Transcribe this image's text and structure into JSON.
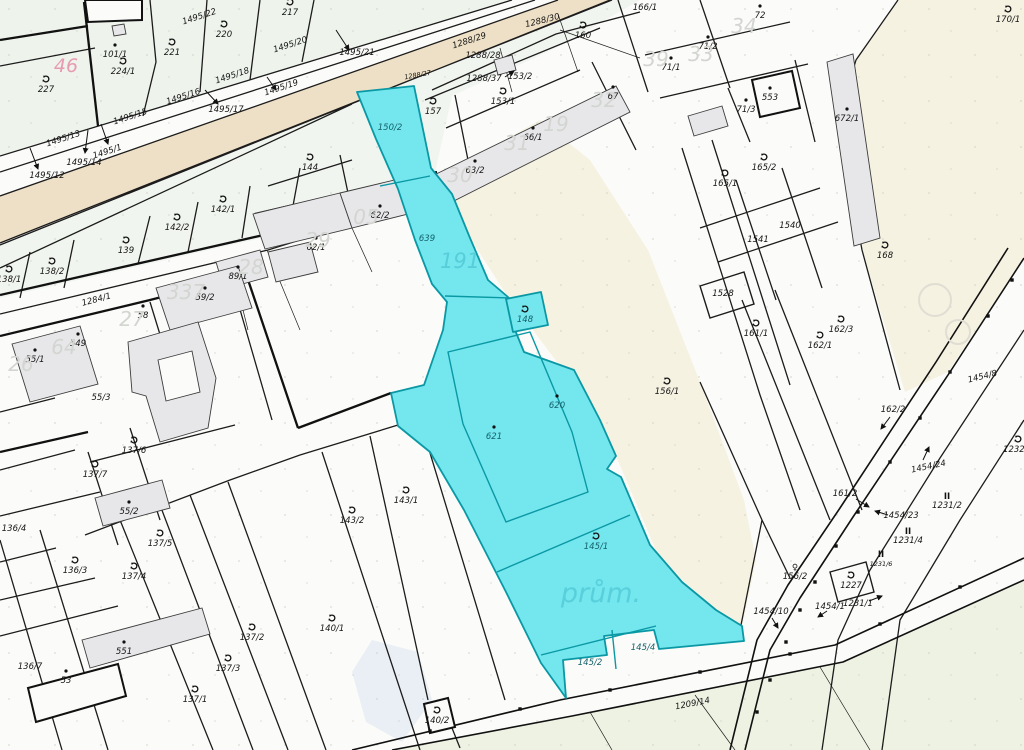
{
  "map": {
    "type": "cadastral-parcel-map",
    "zone_label": "prům.",
    "colors": {
      "highlight_fill": "#73e6ee",
      "highlight_stroke": "#0a98a4",
      "road_fill": "#eee0c6",
      "cream": "#f6f2e2",
      "green_tint": "#eef3ec",
      "bottom_green": "#edf2e3",
      "big_number_gray": "#d2d5d0",
      "pink": "#e79bb1",
      "teal_text": "#15616b",
      "teal_big": "#54cbd8"
    },
    "highlighted_parcels": [
      "150/2",
      "639",
      "148",
      "620",
      "621",
      "145/1",
      "145/2",
      "145/4"
    ]
  },
  "labels": [
    {
      "text": "101/1",
      "x": 115,
      "y": 57,
      "cls": "p",
      "marker": "dot"
    },
    {
      "text": "227",
      "x": 46,
      "y": 92,
      "cls": "p",
      "marker": "sym"
    },
    {
      "text": "224/1",
      "x": 123,
      "y": 74,
      "cls": "p",
      "marker": "sym"
    },
    {
      "text": "221",
      "x": 172,
      "y": 55,
      "cls": "p",
      "marker": "sym"
    },
    {
      "text": "220",
      "x": 224,
      "y": 37,
      "cls": "p",
      "marker": "sym"
    },
    {
      "text": "217",
      "x": 290,
      "y": 15,
      "cls": "p",
      "marker": "sym"
    },
    {
      "text": "144",
      "x": 310,
      "y": 170,
      "cls": "p",
      "marker": "sym"
    },
    {
      "text": "157",
      "x": 433,
      "y": 114,
      "cls": "p",
      "marker": "sym"
    },
    {
      "text": "142/1",
      "x": 223,
      "y": 212,
      "cls": "p",
      "marker": "sym"
    },
    {
      "text": "142/2",
      "x": 177,
      "y": 230,
      "cls": "p",
      "marker": "sym"
    },
    {
      "text": "139",
      "x": 126,
      "y": 253,
      "cls": "p",
      "marker": "sym"
    },
    {
      "text": "138/2",
      "x": 52,
      "y": 274,
      "cls": "p",
      "marker": "sym"
    },
    {
      "text": "138/1",
      "x": 9,
      "y": 282,
      "cls": "p",
      "marker": "sym"
    },
    {
      "text": "59/2",
      "x": 205,
      "y": 300,
      "cls": "p",
      "marker": "dot"
    },
    {
      "text": "89/1",
      "x": 238,
      "y": 279,
      "cls": "p",
      "marker": "dot"
    },
    {
      "text": "62/2",
      "x": 380,
      "y": 218,
      "cls": "p",
      "marker": "dot"
    },
    {
      "text": "62/1",
      "x": 316,
      "y": 250,
      "cls": "p",
      "marker": "dot"
    },
    {
      "text": "58",
      "x": 143,
      "y": 318,
      "cls": "p",
      "marker": "dot"
    },
    {
      "text": "549",
      "x": 78,
      "y": 346,
      "cls": "p",
      "marker": "dot"
    },
    {
      "text": "55/1",
      "x": 35,
      "y": 362,
      "cls": "p",
      "marker": "dot"
    },
    {
      "text": "55/3",
      "x": 101,
      "y": 400,
      "cls": "p"
    },
    {
      "text": "137/6",
      "x": 134,
      "y": 453,
      "cls": "p",
      "marker": "sym"
    },
    {
      "text": "137/7",
      "x": 95,
      "y": 477,
      "cls": "p",
      "marker": "sym"
    },
    {
      "text": "55/2",
      "x": 129,
      "y": 514,
      "cls": "p",
      "marker": "dot"
    },
    {
      "text": "136/4",
      "x": 14,
      "y": 531,
      "cls": "p"
    },
    {
      "text": "136/3",
      "x": 75,
      "y": 573,
      "cls": "p",
      "marker": "sym"
    },
    {
      "text": "137/5",
      "x": 160,
      "y": 546,
      "cls": "p",
      "marker": "sym"
    },
    {
      "text": "137/4",
      "x": 134,
      "y": 579,
      "cls": "p",
      "marker": "sym"
    },
    {
      "text": "551",
      "x": 124,
      "y": 654,
      "cls": "p",
      "marker": "dot"
    },
    {
      "text": "136/7",
      "x": 30,
      "y": 669,
      "cls": "p"
    },
    {
      "text": "53",
      "x": 66,
      "y": 683,
      "cls": "p",
      "marker": "dot"
    },
    {
      "text": "137/2",
      "x": 252,
      "y": 640,
      "cls": "p",
      "marker": "sym"
    },
    {
      "text": "137/3",
      "x": 228,
      "y": 671,
      "cls": "p",
      "marker": "sym"
    },
    {
      "text": "137/1",
      "x": 195,
      "y": 702,
      "cls": "p",
      "marker": "sym"
    },
    {
      "text": "140/1",
      "x": 332,
      "y": 631,
      "cls": "p",
      "marker": "sym"
    },
    {
      "text": "140/2",
      "x": 437,
      "y": 723,
      "cls": "p",
      "marker": "sym"
    },
    {
      "text": "143/1",
      "x": 406,
      "y": 503,
      "cls": "p",
      "marker": "sym"
    },
    {
      "text": "143/2",
      "x": 352,
      "y": 523,
      "cls": "p",
      "marker": "sym"
    },
    {
      "text": "1284/1",
      "x": 97,
      "y": 302,
      "cls": "road",
      "rot": -15
    },
    {
      "text": "1495/22",
      "x": 200,
      "y": 19,
      "cls": "road",
      "rot": -18
    },
    {
      "text": "1495/20",
      "x": 291,
      "y": 47,
      "cls": "road",
      "rot": -18
    },
    {
      "text": "1495/21",
      "x": 357,
      "y": 55,
      "cls": "road"
    },
    {
      "text": "1495/19",
      "x": 282,
      "y": 90,
      "cls": "road",
      "rot": -18
    },
    {
      "text": "1495/18",
      "x": 233,
      "y": 78,
      "cls": "road",
      "rot": -18
    },
    {
      "text": "1495/17",
      "x": 226,
      "y": 112,
      "cls": "road"
    },
    {
      "text": "1495/16",
      "x": 184,
      "y": 99,
      "cls": "road",
      "rot": -18
    },
    {
      "text": "1495/15",
      "x": 131,
      "y": 119,
      "cls": "road",
      "rot": -18
    },
    {
      "text": "1495/13",
      "x": 64,
      "y": 141,
      "cls": "road",
      "rot": -18
    },
    {
      "text": "1495/1",
      "x": 108,
      "y": 154,
      "cls": "road",
      "rot": -18
    },
    {
      "text": "1495/14",
      "x": 84,
      "y": 165,
      "cls": "road"
    },
    {
      "text": "1495/12",
      "x": 47,
      "y": 178,
      "cls": "road"
    },
    {
      "text": "1288/27",
      "x": 418,
      "y": 77,
      "cls": "tiny",
      "rot": -10
    },
    {
      "text": "1288/29",
      "x": 470,
      "y": 43,
      "cls": "road",
      "rot": -18
    },
    {
      "text": "1288/28",
      "x": 483,
      "y": 58,
      "cls": "road"
    },
    {
      "text": "1288/30",
      "x": 543,
      "y": 23,
      "cls": "road",
      "rot": -14
    },
    {
      "text": "1288/37",
      "x": 484,
      "y": 81,
      "cls": "road"
    },
    {
      "text": "153/2",
      "x": 520,
      "y": 79,
      "cls": "p"
    },
    {
      "text": "153/1",
      "x": 503,
      "y": 104,
      "cls": "p",
      "marker": "sym"
    },
    {
      "text": "160",
      "x": 583,
      "y": 38,
      "cls": "p",
      "marker": "sym"
    },
    {
      "text": "166/1",
      "x": 645,
      "y": 10,
      "cls": "p",
      "marker": "dot"
    },
    {
      "text": "72",
      "x": 760,
      "y": 18,
      "cls": "p",
      "marker": "dot"
    },
    {
      "text": "71/2",
      "x": 708,
      "y": 49,
      "cls": "p",
      "marker": "dot"
    },
    {
      "text": "71/1",
      "x": 671,
      "y": 70,
      "cls": "p",
      "marker": "dot"
    },
    {
      "text": "71/3",
      "x": 746,
      "y": 112,
      "cls": "p",
      "marker": "dot"
    },
    {
      "text": "553",
      "x": 770,
      "y": 100,
      "cls": "p",
      "marker": "dot"
    },
    {
      "text": "67",
      "x": 613,
      "y": 99,
      "cls": "p",
      "marker": "dot"
    },
    {
      "text": "66/1",
      "x": 533,
      "y": 140,
      "cls": "p",
      "marker": "dot"
    },
    {
      "text": "63/2",
      "x": 475,
      "y": 173,
      "cls": "p",
      "marker": "dot"
    },
    {
      "text": "672/1",
      "x": 847,
      "y": 121,
      "cls": "p",
      "marker": "dot"
    },
    {
      "text": "170/1",
      "x": 1008,
      "y": 22,
      "cls": "p",
      "marker": "sym"
    },
    {
      "text": "165/1",
      "x": 725,
      "y": 186,
      "cls": "p",
      "marker": "sym"
    },
    {
      "text": "165/2",
      "x": 764,
      "y": 170,
      "cls": "p",
      "marker": "sym"
    },
    {
      "text": "1540",
      "x": 790,
      "y": 228,
      "cls": "p"
    },
    {
      "text": "1541",
      "x": 758,
      "y": 242,
      "cls": "p"
    },
    {
      "text": "1528",
      "x": 723,
      "y": 296,
      "cls": "p"
    },
    {
      "text": "161/1",
      "x": 756,
      "y": 336,
      "cls": "p",
      "marker": "sym"
    },
    {
      "text": "162/1",
      "x": 820,
      "y": 348,
      "cls": "p",
      "marker": "sym"
    },
    {
      "text": "162/3",
      "x": 841,
      "y": 332,
      "cls": "p",
      "marker": "sym"
    },
    {
      "text": "168",
      "x": 885,
      "y": 258,
      "cls": "p",
      "marker": "sym"
    },
    {
      "text": "156/1",
      "x": 667,
      "y": 394,
      "cls": "p",
      "marker": "sym"
    },
    {
      "text": "1454/8",
      "x": 983,
      "y": 379,
      "cls": "road",
      "rot": -14
    },
    {
      "text": "162/2",
      "x": 893,
      "y": 412,
      "cls": "p"
    },
    {
      "text": "1454/24",
      "x": 929,
      "y": 469,
      "cls": "road",
      "rot": -12
    },
    {
      "text": "1232/1",
      "x": 1018,
      "y": 452,
      "cls": "p",
      "marker": "sym"
    },
    {
      "text": "1231/2",
      "x": 947,
      "y": 508,
      "cls": "p",
      "marker": "II"
    },
    {
      "text": "1231/4",
      "x": 908,
      "y": 543,
      "cls": "p",
      "marker": "II"
    },
    {
      "text": "1231/6",
      "x": 881,
      "y": 566,
      "cls": "tiny",
      "marker": "II"
    },
    {
      "text": "161/2",
      "x": 845,
      "y": 496,
      "cls": "p"
    },
    {
      "text": "1454/23",
      "x": 901,
      "y": 518,
      "cls": "road"
    },
    {
      "text": "1227",
      "x": 851,
      "y": 588,
      "cls": "p",
      "marker": "sym"
    },
    {
      "text": "1231/1",
      "x": 858,
      "y": 606,
      "cls": "p"
    },
    {
      "text": "1454/1",
      "x": 830,
      "y": 609,
      "cls": "road"
    },
    {
      "text": "156/2",
      "x": 795,
      "y": 579,
      "cls": "p",
      "marker": "fem"
    },
    {
      "text": "1454/10",
      "x": 771,
      "y": 614,
      "cls": "road"
    },
    {
      "text": "1209/14",
      "x": 693,
      "y": 706,
      "cls": "road",
      "rot": -11
    },
    {
      "text": "150/2",
      "x": 390,
      "y": 130,
      "cls": "t"
    },
    {
      "text": "639",
      "x": 427,
      "y": 241,
      "cls": "t"
    },
    {
      "text": "148",
      "x": 525,
      "y": 322,
      "cls": "t",
      "marker": "sym"
    },
    {
      "text": "620",
      "x": 557,
      "y": 408,
      "cls": "t",
      "marker": "dot"
    },
    {
      "text": "621",
      "x": 494,
      "y": 439,
      "cls": "t",
      "marker": "dot"
    },
    {
      "text": "145/1",
      "x": 596,
      "y": 549,
      "cls": "t",
      "marker": "sym"
    },
    {
      "text": "145/2",
      "x": 590,
      "y": 665,
      "cls": "t"
    },
    {
      "text": "145/4",
      "x": 643,
      "y": 650,
      "cls": "t"
    },
    {
      "text": "46",
      "x": 66,
      "y": 72,
      "cls": "pink"
    },
    {
      "text": "34",
      "x": 744,
      "y": 33,
      "cls": "big"
    },
    {
      "text": "33",
      "x": 701,
      "y": 61,
      "cls": "big"
    },
    {
      "text": "39",
      "x": 656,
      "y": 66,
      "cls": "big"
    },
    {
      "text": "32",
      "x": 604,
      "y": 107,
      "cls": "big"
    },
    {
      "text": "19",
      "x": 556,
      "y": 131,
      "cls": "big"
    },
    {
      "text": "31",
      "x": 517,
      "y": 150,
      "cls": "big"
    },
    {
      "text": "30",
      "x": 460,
      "y": 182,
      "cls": "big"
    },
    {
      "text": "29",
      "x": 318,
      "y": 247,
      "cls": "big"
    },
    {
      "text": "05",
      "x": 366,
      "y": 224,
      "cls": "big"
    },
    {
      "text": "28",
      "x": 251,
      "y": 274,
      "cls": "big"
    },
    {
      "text": "337",
      "x": 186,
      "y": 299,
      "cls": "big"
    },
    {
      "text": "27",
      "x": 132,
      "y": 326,
      "cls": "big"
    },
    {
      "text": "64",
      "x": 64,
      "y": 354,
      "cls": "big"
    },
    {
      "text": "26",
      "x": 21,
      "y": 371,
      "cls": "big"
    },
    {
      "text": "191",
      "x": 460,
      "y": 268,
      "cls": "bigteal"
    },
    {
      "text": "prům.",
      "x": 601,
      "y": 602,
      "cls": "prum"
    }
  ],
  "arrows": [
    {
      "x1": 336,
      "y1": 30,
      "x2": 349,
      "y2": 50
    },
    {
      "x1": 267,
      "y1": 77,
      "x2": 276,
      "y2": 90
    },
    {
      "x1": 205,
      "y1": 90,
      "x2": 218,
      "y2": 104
    },
    {
      "x1": 88,
      "y1": 130,
      "x2": 85,
      "y2": 153
    },
    {
      "x1": 101,
      "y1": 124,
      "x2": 108,
      "y2": 144
    },
    {
      "x1": 30,
      "y1": 148,
      "x2": 38,
      "y2": 169
    },
    {
      "x1": 505,
      "y1": 77,
      "x2": 514,
      "y2": 71
    },
    {
      "x1": 890,
      "y1": 417,
      "x2": 881,
      "y2": 429
    },
    {
      "x1": 923,
      "y1": 460,
      "x2": 929,
      "y2": 447
    },
    {
      "x1": 856,
      "y1": 499,
      "x2": 869,
      "y2": 507
    },
    {
      "x1": 888,
      "y1": 515,
      "x2": 875,
      "y2": 511
    },
    {
      "x1": 869,
      "y1": 601,
      "x2": 882,
      "y2": 596
    },
    {
      "x1": 827,
      "y1": 611,
      "x2": 818,
      "y2": 617
    },
    {
      "x1": 772,
      "y1": 618,
      "x2": 778,
      "y2": 628
    }
  ],
  "road_points": [
    [
      950,
      372
    ],
    [
      920,
      418
    ],
    [
      890,
      462
    ],
    [
      858,
      512
    ],
    [
      836,
      546
    ],
    [
      815,
      582
    ],
    [
      800,
      610
    ],
    [
      786,
      642
    ],
    [
      770,
      680
    ],
    [
      757,
      712
    ],
    [
      988,
      316
    ],
    [
      1012,
      280
    ],
    [
      430,
      731
    ],
    [
      520,
      709
    ],
    [
      610,
      690
    ],
    [
      700,
      672
    ],
    [
      790,
      654
    ],
    [
      880,
      624
    ],
    [
      960,
      587
    ]
  ]
}
